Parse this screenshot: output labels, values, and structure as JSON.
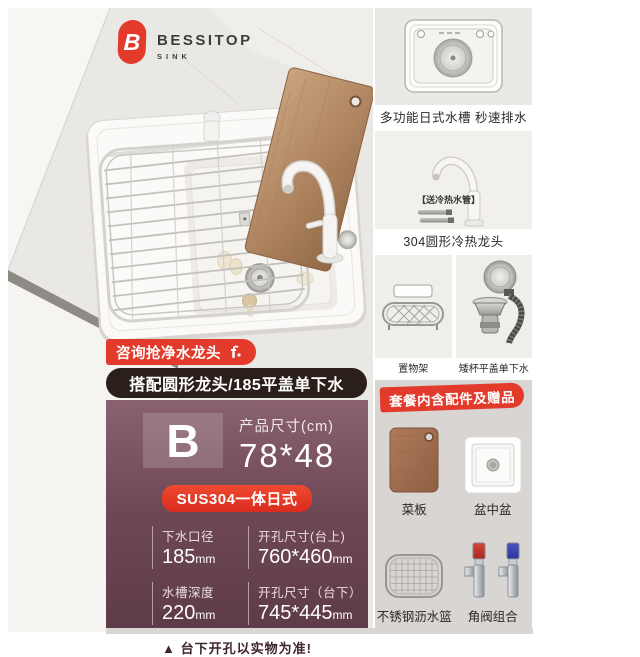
{
  "brand": {
    "name": "BESSITOP",
    "sub": "SINK",
    "logo_letter": "B"
  },
  "photo_overlays": {
    "consult_badge": "咨询抢净水龙头",
    "combo_pill": "搭配圆形龙头/185平盖单下水"
  },
  "right_panels": {
    "sink_top": {
      "caption": "多功能日式水槽 秒速排水"
    },
    "faucet": {
      "caption": "304圆形冷热龙头",
      "tag": "【送冷热水管】"
    },
    "rack": {
      "caption": "置物架"
    },
    "drain": {
      "caption": "矮杯平盖单下水"
    }
  },
  "gift_section": {
    "title": "套餐内含配件及赠品",
    "items": [
      {
        "label": "菜板"
      },
      {
        "label": "盆中盆"
      },
      {
        "label": "不锈钢沥水篮"
      },
      {
        "label": "角阀组合"
      }
    ]
  },
  "info_panel": {
    "variant_letter": "B",
    "size_label": "产品尺寸(cm)",
    "size_value": "78*48",
    "material_badge": "SUS304一体日式",
    "specs": [
      {
        "label": "下水口径",
        "value": "185",
        "unit": "mm"
      },
      {
        "label": "开孔尺寸(台上)",
        "value": "760*460",
        "unit": "mm"
      },
      {
        "label": "水槽深度",
        "value": "220",
        "unit": "mm"
      },
      {
        "label": "开孔尺寸（台下）",
        "value": "745*445",
        "unit": "mm"
      }
    ],
    "warning_icon": "▲",
    "warning": "台下开孔以实物为准!"
  },
  "colors": {
    "accent_red": "#e23a2b",
    "panel_maroon_top": "#8a6171",
    "panel_maroon_bottom": "#5e3b48",
    "pill_dark": "#2b1f1a",
    "gift_bg": "#d8d5d2"
  }
}
